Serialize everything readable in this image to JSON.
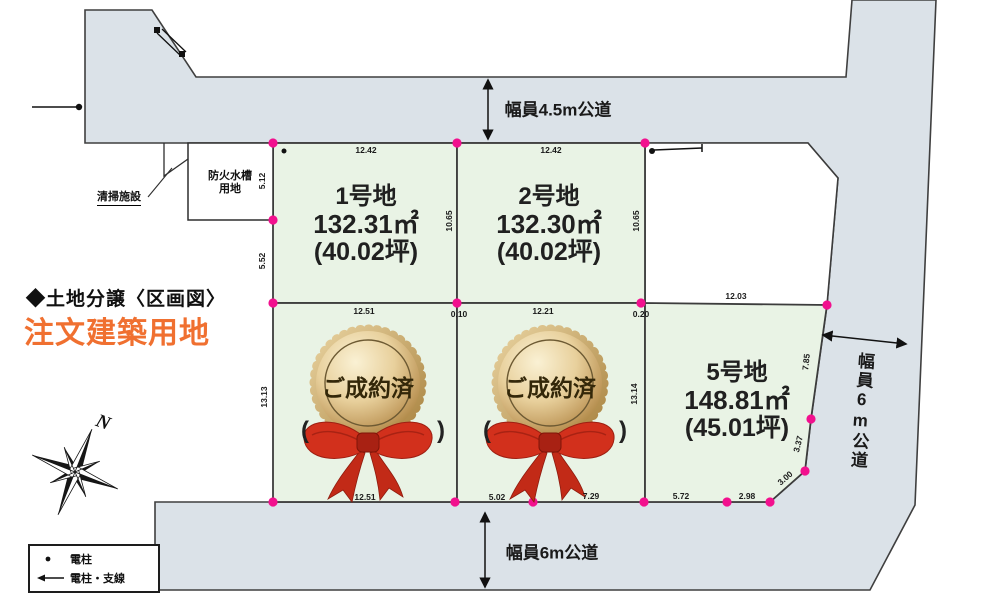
{
  "title": {
    "heading": "◆土地分譲〈区画図〉",
    "subtitle": "注文建築用地",
    "subtitle_color": "#f07030"
  },
  "roads": {
    "top": "幅員4.5m公道",
    "bottom": "幅員6m公道",
    "right": "幅員6m公道"
  },
  "facilities": {
    "cleaning": "清掃施設",
    "fire_tank_line1": "防火水槽",
    "fire_tank_line2": "用地"
  },
  "plots": {
    "plot1": {
      "name": "1号地",
      "area_m2": "132.31㎡",
      "area_tsubo": "(40.02坪)"
    },
    "plot2": {
      "name": "2号地",
      "area_m2": "132.30㎡",
      "area_tsubo": "(40.02坪)"
    },
    "plot5": {
      "name": "5号地",
      "area_m2": "148.81㎡",
      "area_tsubo": "(45.01坪)"
    },
    "sold_seal": "ご成約済",
    "paren_open": "(",
    "paren_close": ")"
  },
  "dims": {
    "p1_top": "12.42",
    "p2_top": "12.42",
    "left_upper": "5.12",
    "left_lower": "5.52",
    "p1_right": "10.65",
    "p2_right": "10.65",
    "mid_p3": "12.51",
    "mid_gap1": "0.10",
    "mid_p4": "12.21",
    "mid_gap2": "0.20",
    "p5_top": "12.03",
    "p3_left": "13.13",
    "p4_right": "13.14",
    "p5_right_upper": "7.85",
    "p5_right_lower": "3.37",
    "p5_corner": "3.00",
    "bot_p3": "12.51",
    "bot_p4a": "5.02",
    "bot_p4b": "7.29",
    "bot_p5a": "5.72",
    "bot_p5b": "2.98"
  },
  "legend": {
    "pole": "電柱",
    "pole_wire": "電柱・支線"
  },
  "compass": {
    "north": "N"
  },
  "colors": {
    "road_gray": "#dbe2e8",
    "plot_green": "#e9f3e5",
    "corner_pink": "#f2108e",
    "seal_gold": "#c9a55c",
    "ribbon_red": "#d2301c",
    "subtitle_orange": "#f07030"
  }
}
